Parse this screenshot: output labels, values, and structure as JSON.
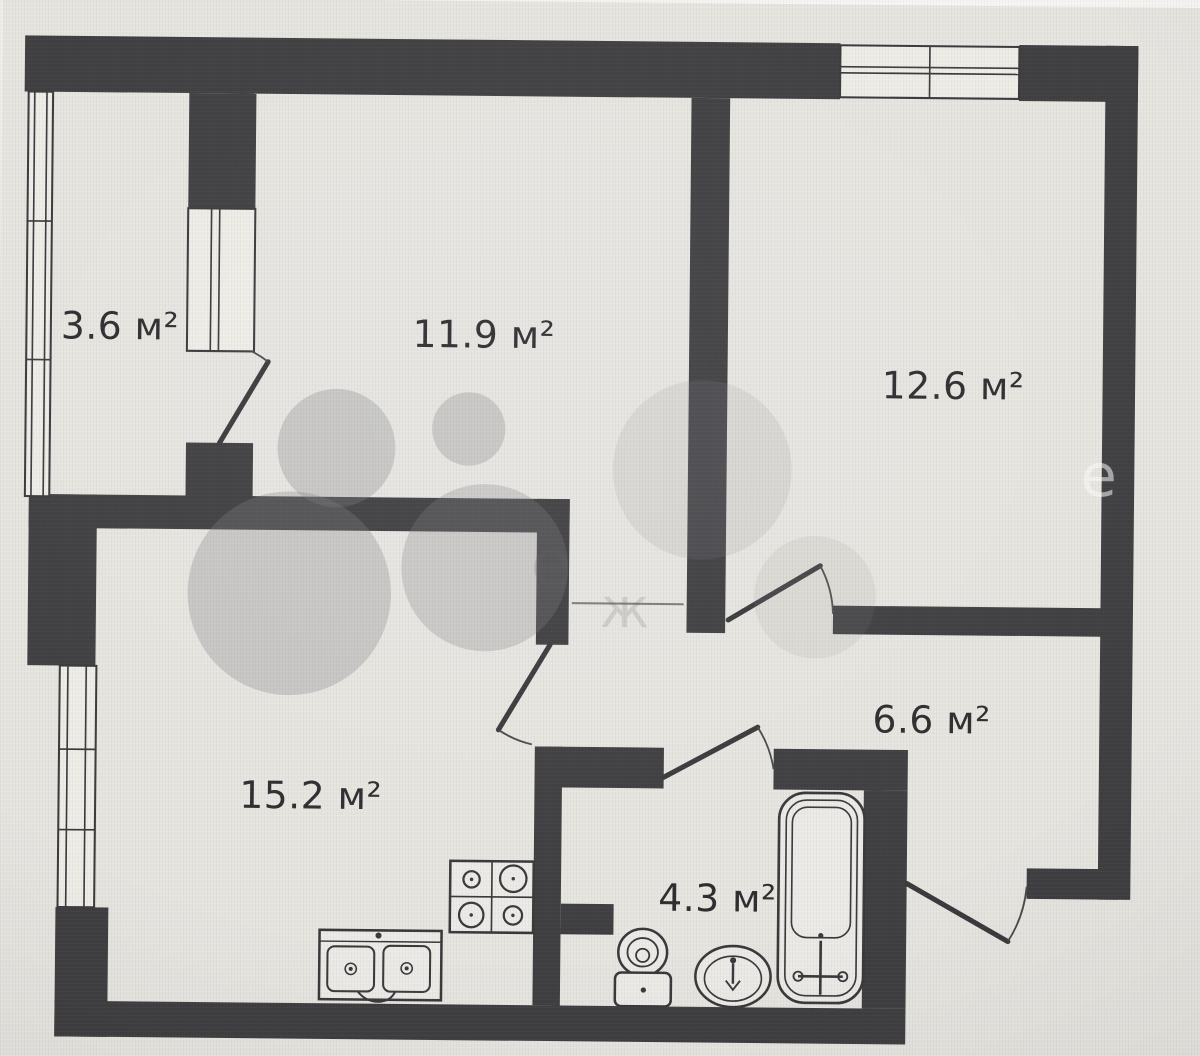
{
  "floor_plan": {
    "unit_suffix": "м²",
    "rooms": [
      {
        "key": "balcony",
        "label": "3.6 м²"
      },
      {
        "key": "room_a",
        "label": "11.9 м²"
      },
      {
        "key": "room_b",
        "label": "12.6 м²"
      },
      {
        "key": "kitchen_living",
        "label": "15.2 м²"
      },
      {
        "key": "hallway",
        "label": "6.6 м²"
      },
      {
        "key": "bathroom",
        "label": "4.3 м²"
      }
    ],
    "fixtures": [
      "stove-4-burner",
      "kitchen-double-sink",
      "toilet",
      "washbasin",
      "bathtub"
    ],
    "watermark": {
      "ghost_letters": [
        "е",
        "ж",
        "е"
      ]
    },
    "colors": {
      "wall": "#403f42",
      "paper": "#e9e7e2",
      "fixture_fill": "#efede9",
      "label_text": "#2e2d30",
      "watermark_gray": "#828285"
    }
  }
}
